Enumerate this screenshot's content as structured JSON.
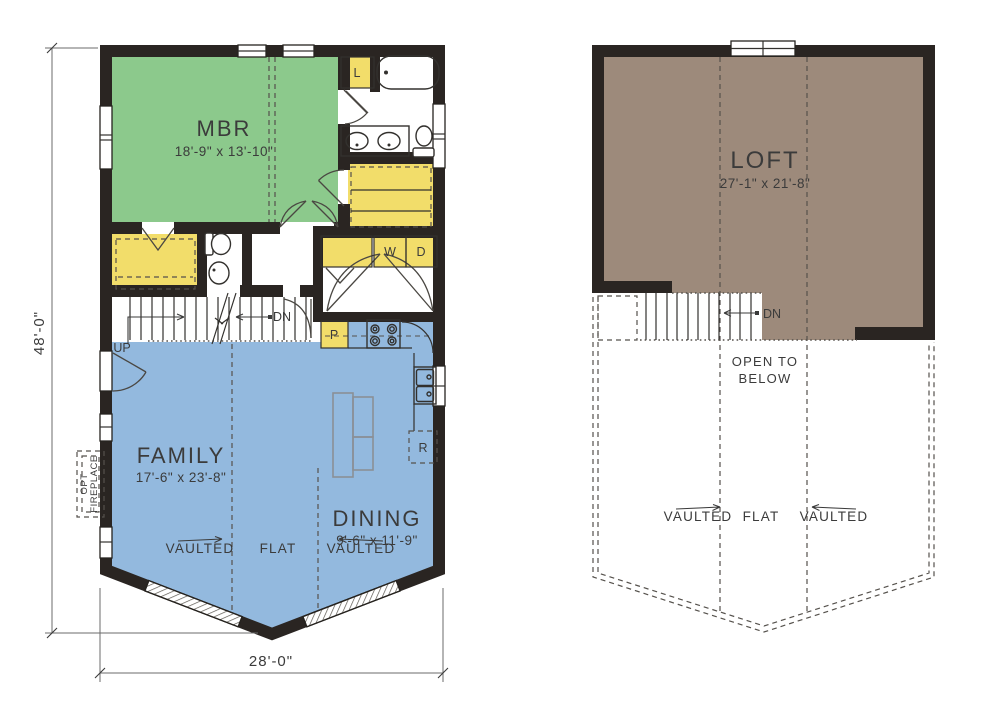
{
  "drawing": {
    "type": "residential floor plan, two levels side by side",
    "colors": {
      "wall": "#2a2522",
      "mbr_green": "#8cc98c",
      "living_blue": "#93b9de",
      "closet_yellow": "#f2dd6a",
      "loft_brown": "#9d8a7b",
      "text": "#3b3b3b"
    }
  },
  "first_floor": {
    "rooms": {
      "mbr": {
        "name": "MBR",
        "dims": "18'-9\" x 13'-10\""
      },
      "family": {
        "name": "FAMILY",
        "dims": "17'-6\" x 23'-8\""
      },
      "dining": {
        "name": "DINING",
        "dims": "9'-6\" x 11'-9\""
      }
    },
    "labels": {
      "up": "UP",
      "dn": "DN",
      "washer": "W",
      "dryer": "D",
      "pantry": "P",
      "linen": "L",
      "refrigerator": "R",
      "opt_fireplace_line1": "OPT",
      "opt_fireplace_line2": "FIREPLACE"
    },
    "ceiling": {
      "vaulted_left": "VAULTED",
      "flat": "FLAT",
      "vaulted_right": "VAULTED"
    },
    "dimensions": {
      "depth": "48'-0\"",
      "width": "28'-0\""
    }
  },
  "second_floor": {
    "rooms": {
      "loft": {
        "name": "LOFT",
        "dims": "27'-1\" x 21'-8\""
      }
    },
    "labels": {
      "dn": "DN",
      "open_to_below_line1": "OPEN TO",
      "open_to_below_line2": "BELOW"
    },
    "ceiling": {
      "vaulted_left": "VAULTED",
      "flat": "FLAT",
      "vaulted_right": "VAULTED"
    }
  }
}
